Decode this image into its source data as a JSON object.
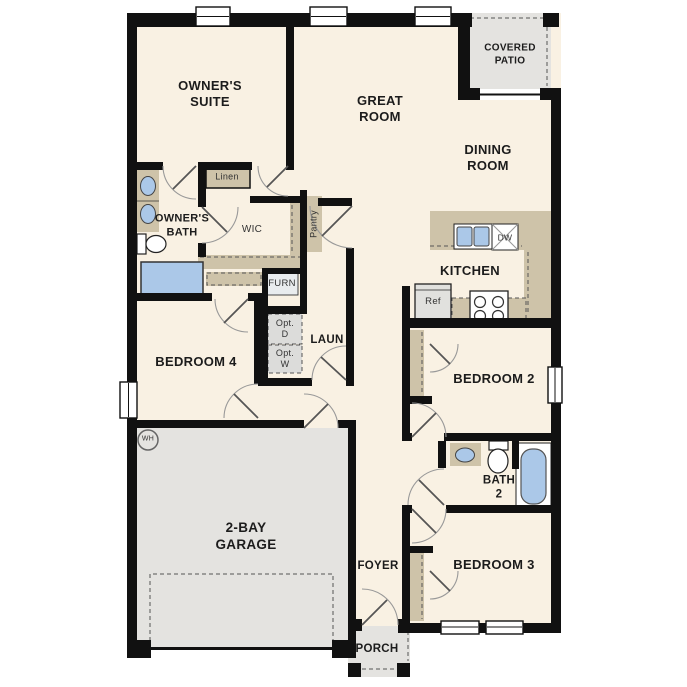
{
  "plan": {
    "type": "single-story-floor-plan",
    "colors": {
      "floor": "#f9f1e3",
      "wall": "#111111",
      "cabinet": "#cec3a9",
      "plumbing_blue": "#abc8e8",
      "concrete_gray": "#e4e3e0",
      "optional_gray": "#dcdcda",
      "door_arc": "#999999",
      "door_leaf": "#555555",
      "label_text": "#1c1c1c"
    },
    "rooms": [
      "Owner's Suite",
      "Owner's Bath",
      "WIC",
      "Great Room",
      "Covered Patio",
      "Dining Room",
      "Kitchen",
      "Laundry",
      "Bedroom 4",
      "Bedroom 2",
      "Bath 2",
      "Bedroom 3",
      "2-Bay Garage",
      "Foyer",
      "Porch"
    ],
    "fixtures": [
      "double-vanity",
      "toilet",
      "tub",
      "linen-shelf",
      "pantry-shelf",
      "furnace",
      "optional-dryer",
      "optional-washer",
      "kitchen-sink",
      "dishwasher",
      "refrigerator",
      "range",
      "water-heater",
      "bath2-vanity",
      "bath2-toilet",
      "bath2-tub",
      "sliding-patio-door",
      "garage-door"
    ]
  },
  "labels": {
    "owners_suite": {
      "text": "OWNER'S\nSUITE",
      "x": 210,
      "y": 94,
      "size": 13,
      "weight": 700
    },
    "great_room": {
      "text": "GREAT\nROOM",
      "x": 380,
      "y": 109,
      "size": 13,
      "weight": 700
    },
    "covered_patio": {
      "text": "COVERED\nPATIO",
      "x": 510,
      "y": 55,
      "size": 10,
      "weight": 700
    },
    "dining_room": {
      "text": "DINING\nROOM",
      "x": 488,
      "y": 158,
      "size": 13,
      "weight": 700
    },
    "owners_bath": {
      "text": "OWNER'S\nBATH",
      "x": 182,
      "y": 226,
      "size": 11,
      "weight": 700
    },
    "linen": {
      "text": "Linen",
      "x": 227,
      "y": 177,
      "size": 9,
      "weight": 400
    },
    "wic": {
      "text": "WIC",
      "x": 252,
      "y": 230,
      "size": 10,
      "weight": 400
    },
    "pantry": {
      "text": "Pantry",
      "x": 314,
      "y": 224,
      "size": 9,
      "weight": 400,
      "rotate": -90
    },
    "furn": {
      "text": "FURN",
      "x": 282,
      "y": 284,
      "size": 9.5,
      "weight": 400
    },
    "kitchen": {
      "text": "KITCHEN",
      "x": 470,
      "y": 271,
      "size": 13,
      "weight": 700
    },
    "ref": {
      "text": "Ref",
      "x": 433,
      "y": 302,
      "size": 9.5,
      "weight": 400
    },
    "dw": {
      "text": "DW",
      "x": 505,
      "y": 238,
      "size": 8.5,
      "weight": 400
    },
    "opt_d": {
      "text": "Opt.\nD",
      "x": 285,
      "y": 329,
      "size": 9,
      "weight": 400
    },
    "opt_w": {
      "text": "Opt.\nW",
      "x": 285,
      "y": 359,
      "size": 9,
      "weight": 400
    },
    "laun": {
      "text": "LAUN",
      "x": 327,
      "y": 340,
      "size": 11.5,
      "weight": 700
    },
    "bedroom_4": {
      "text": "BEDROOM 4",
      "x": 196,
      "y": 362,
      "size": 13,
      "weight": 700
    },
    "bedroom_2": {
      "text": "BEDROOM 2",
      "x": 494,
      "y": 379,
      "size": 13,
      "weight": 700
    },
    "bath_2": {
      "text": "BATH\n2",
      "x": 499,
      "y": 488,
      "size": 11.5,
      "weight": 700
    },
    "bedroom_3": {
      "text": "BEDROOM 3",
      "x": 494,
      "y": 565,
      "size": 13,
      "weight": 700
    },
    "wh": {
      "text": "WH",
      "x": 148,
      "y": 440,
      "size": 7,
      "weight": 400
    },
    "garage": {
      "text": "2-BAY\nGARAGE",
      "x": 246,
      "y": 537,
      "size": 13.5,
      "weight": 700
    },
    "foyer": {
      "text": "FOYER",
      "x": 378,
      "y": 566,
      "size": 11.5,
      "weight": 700
    },
    "porch": {
      "text": "PORCH",
      "x": 377,
      "y": 649,
      "size": 11.5,
      "weight": 700
    }
  }
}
